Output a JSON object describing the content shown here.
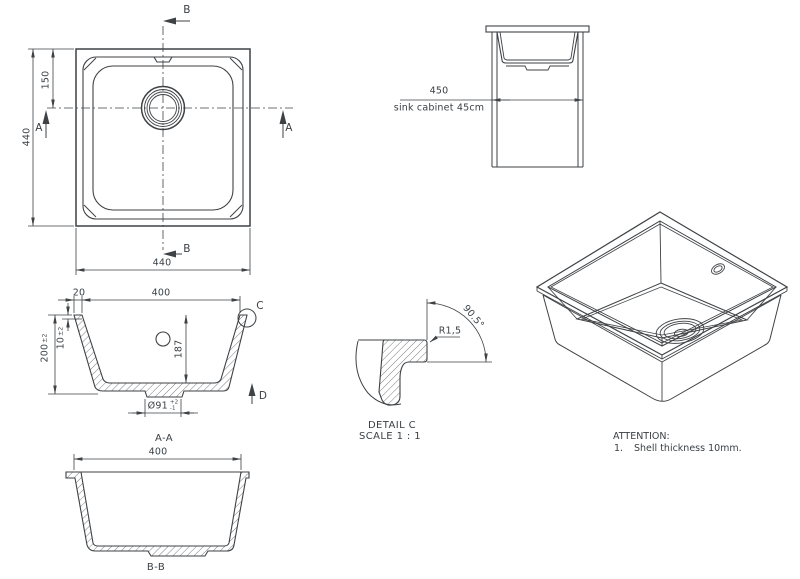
{
  "colors": {
    "background": "#ffffff",
    "line": "#3f4245",
    "text": "#3a4045"
  },
  "top_view": {
    "section_marker_b_top": "B",
    "section_marker_b_bottom": "B",
    "section_marker_a_left": "A",
    "section_marker_a_right": "A",
    "dim_side": "440",
    "dim_drain_offset": "150",
    "dim_bottom": "440"
  },
  "cabinet_view": {
    "dim_width": "450",
    "caption": "sink cabinet 45cm"
  },
  "section_aa": {
    "title": "A-A",
    "dim_rim": "20",
    "dim_inner_width": "400",
    "dim_depth": "200",
    "dim_depth_tol": "±2",
    "dim_wall": "10",
    "dim_wall_tol": "±2",
    "dim_inner_depth": "187",
    "dim_drain_diameter": "Ø91",
    "dim_drain_tol_plus": "+2",
    "dim_drain_tol_minus": "-1",
    "detail_marker": "C",
    "direction_marker": "D"
  },
  "section_bb": {
    "title": "B-B",
    "dim_inner_width": "400"
  },
  "detail_c": {
    "title": "DETAIL C",
    "scale": "SCALE 1 : 1",
    "radius": "R1,5",
    "angle": "90.5°"
  },
  "notes": {
    "heading": "ATTENTION:",
    "item_number": "1.",
    "item_text": "Shell thickness 10mm."
  }
}
